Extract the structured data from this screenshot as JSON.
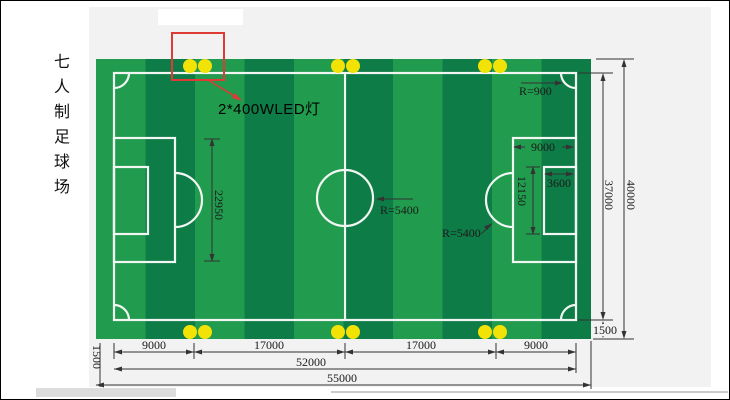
{
  "title": {
    "text": "七人制足球场"
  },
  "annotations": {
    "led_label": "2*400WLED灯",
    "corner_radius": "R=900",
    "center_circle_radius": "R=5400",
    "penalty_arc_radius": "R=5400"
  },
  "dimensions": {
    "penalty_area_height": "22950",
    "goal_area_height": "12150",
    "penalty_area_width": "9000",
    "goal_area_width": "3600",
    "field_length": "37000",
    "total_length": "40000",
    "margin_right": "1500",
    "margin_left": "1500",
    "bottom_segments": [
      "9000",
      "17000",
      "17000",
      "9000"
    ],
    "field_width": "52000",
    "total_width": "55000"
  },
  "colors": {
    "canvas_bg": "#ffffff",
    "panel_bg": "#f3f2f2",
    "grass_light": "#219b4e",
    "grass_dark": "#0e7c47",
    "line_white": "#f2f6f2",
    "light_yellow": "#f2e205",
    "highlight_red": "#e03a34",
    "dim_line": "#333333",
    "dim_text": "#1a1a1a"
  }
}
